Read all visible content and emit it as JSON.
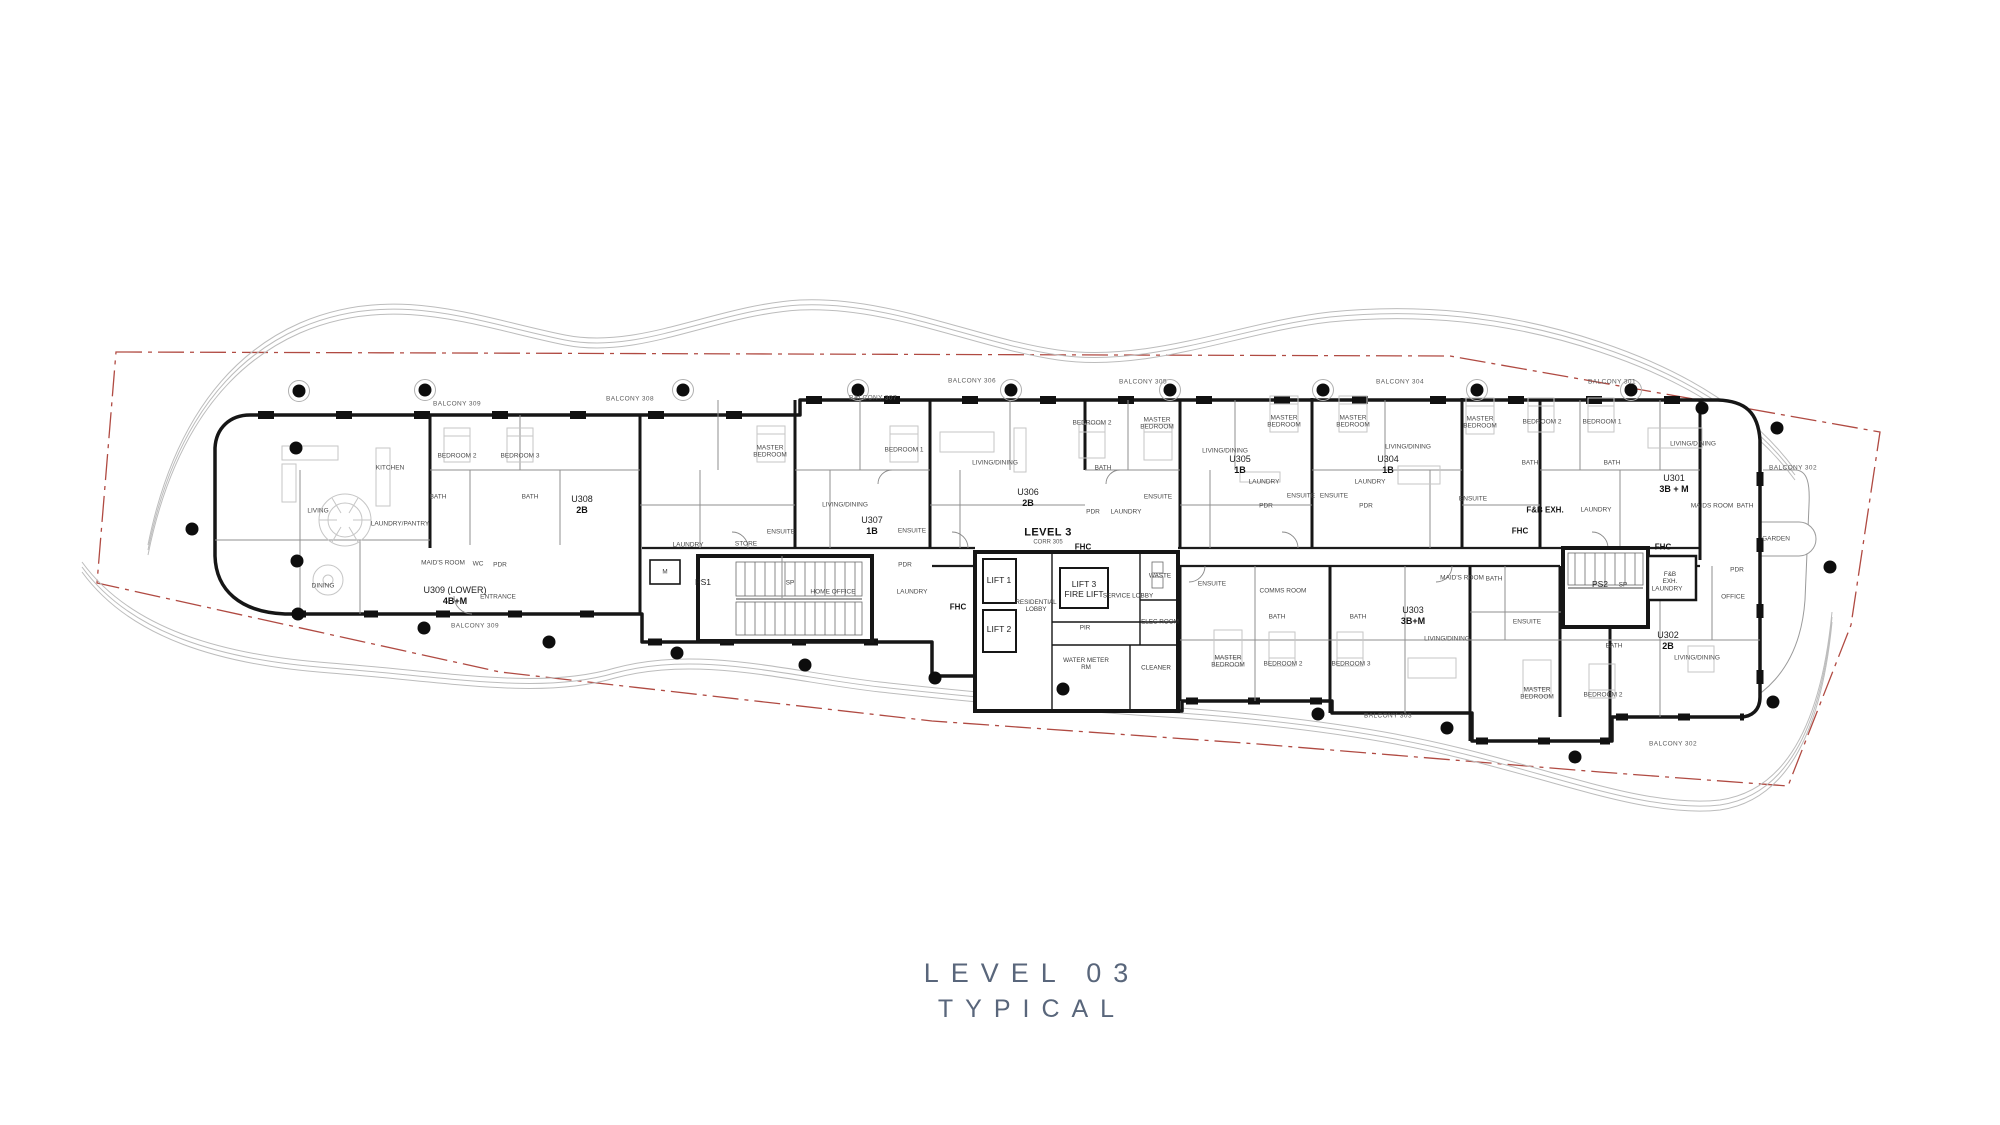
{
  "title": {
    "line1": "LEVEL 03",
    "line2": "TYPICAL"
  },
  "colors": {
    "boundary_red": "#b04a42",
    "wall_black": "#161616",
    "landscape_gray": "#b9b9b9",
    "furniture_gray": "#c6c6c6",
    "title_color": "#59667b"
  },
  "plan": {
    "level_label": "LEVEL 3",
    "corridor_label": "CORR 305",
    "units": [
      {
        "id": "U309 (LOWER)",
        "type": "4B+M"
      },
      {
        "id": "U308",
        "type": "2B"
      },
      {
        "id": "U307",
        "type": "1B"
      },
      {
        "id": "U306",
        "type": "2B"
      },
      {
        "id": "U305",
        "type": "1B"
      },
      {
        "id": "U304",
        "type": "1B"
      },
      {
        "id": "U303",
        "type": "3B+M"
      },
      {
        "id": "U302",
        "type": "2B"
      },
      {
        "id": "U301",
        "type": "3B + M"
      }
    ],
    "labels": [
      {
        "t": "U309 (LOWER)",
        "x": 455,
        "y": 590,
        "k": "uid"
      },
      {
        "t": "4B+M",
        "x": 455,
        "y": 601,
        "k": "utype"
      },
      {
        "t": "U308",
        "x": 582,
        "y": 499,
        "k": "uid"
      },
      {
        "t": "2B",
        "x": 582,
        "y": 510,
        "k": "utype"
      },
      {
        "t": "U307",
        "x": 872,
        "y": 520,
        "k": "uid"
      },
      {
        "t": "1B",
        "x": 872,
        "y": 531,
        "k": "utype"
      },
      {
        "t": "U306",
        "x": 1028,
        "y": 492,
        "k": "uid"
      },
      {
        "t": "2B",
        "x": 1028,
        "y": 503,
        "k": "utype"
      },
      {
        "t": "U305",
        "x": 1240,
        "y": 459,
        "k": "uid"
      },
      {
        "t": "1B",
        "x": 1240,
        "y": 470,
        "k": "utype"
      },
      {
        "t": "U304",
        "x": 1388,
        "y": 459,
        "k": "uid"
      },
      {
        "t": "1B",
        "x": 1388,
        "y": 470,
        "k": "utype"
      },
      {
        "t": "U301",
        "x": 1674,
        "y": 478,
        "k": "uid"
      },
      {
        "t": "3B + M",
        "x": 1674,
        "y": 489,
        "k": "utype"
      },
      {
        "t": "U303",
        "x": 1413,
        "y": 610,
        "k": "uid"
      },
      {
        "t": "3B+M",
        "x": 1413,
        "y": 621,
        "k": "utype"
      },
      {
        "t": "U302",
        "x": 1668,
        "y": 635,
        "k": "uid"
      },
      {
        "t": "2B",
        "x": 1668,
        "y": 646,
        "k": "utype"
      },
      {
        "t": "LEVEL 3",
        "x": 1048,
        "y": 533,
        "k": "corr"
      },
      {
        "t": "CORR 305",
        "x": 1048,
        "y": 543,
        "k": "corrsub"
      },
      {
        "t": "FHC",
        "x": 958,
        "y": 607,
        "k": "fhc"
      },
      {
        "t": "FHC",
        "x": 1083,
        "y": 547,
        "k": "fhc"
      },
      {
        "t": "FHC",
        "x": 1520,
        "y": 531,
        "k": "fhc"
      },
      {
        "t": "FHC",
        "x": 1663,
        "y": 547,
        "k": "fhc"
      },
      {
        "t": "LIFT 1",
        "x": 999,
        "y": 581,
        "k": "lift"
      },
      {
        "t": "LIFT 2",
        "x": 999,
        "y": 630,
        "k": "lift"
      },
      {
        "t": "LIFT 3\nFIRE LIFT",
        "x": 1084,
        "y": 590,
        "k": "lift"
      },
      {
        "t": "RESIDENTIAL\nLOBBY",
        "x": 1036,
        "y": 606,
        "k": "core"
      },
      {
        "t": "SERVICE LOBBY",
        "x": 1128,
        "y": 596,
        "k": "core"
      },
      {
        "t": "WASTE",
        "x": 1160,
        "y": 576,
        "k": "core"
      },
      {
        "t": "ELEC ROOM",
        "x": 1160,
        "y": 622,
        "k": "core"
      },
      {
        "t": "PIR",
        "x": 1085,
        "y": 628,
        "k": "core"
      },
      {
        "t": "WATER METER\nRM",
        "x": 1086,
        "y": 664,
        "k": "core"
      },
      {
        "t": "CLEANER",
        "x": 1156,
        "y": 668,
        "k": "core"
      },
      {
        "t": "M",
        "x": 665,
        "y": 572,
        "k": "core"
      },
      {
        "t": "PS1",
        "x": 703,
        "y": 583,
        "k": "lift"
      },
      {
        "t": "SP",
        "x": 790,
        "y": 583,
        "k": "core"
      },
      {
        "t": "PS2",
        "x": 1600,
        "y": 585,
        "k": "lift"
      },
      {
        "t": "SP",
        "x": 1623,
        "y": 585,
        "k": "core"
      },
      {
        "t": "F&B\nEXH.",
        "x": 1670,
        "y": 578,
        "k": "core"
      },
      {
        "t": "F&B EXH.",
        "x": 1545,
        "y": 510,
        "k": "fhc"
      },
      {
        "t": "LIVING",
        "x": 318,
        "y": 511,
        "k": "room"
      },
      {
        "t": "DINING",
        "x": 323,
        "y": 586,
        "k": "room"
      },
      {
        "t": "KITCHEN",
        "x": 390,
        "y": 468,
        "k": "room"
      },
      {
        "t": "LAUNDRY/PANTRY",
        "x": 400,
        "y": 524,
        "k": "room"
      },
      {
        "t": "MAID'S ROOM",
        "x": 443,
        "y": 563,
        "k": "room"
      },
      {
        "t": "WC",
        "x": 478,
        "y": 564,
        "k": "room"
      },
      {
        "t": "PDR",
        "x": 500,
        "y": 565,
        "k": "room"
      },
      {
        "t": "ENTRANCE",
        "x": 498,
        "y": 597,
        "k": "room"
      },
      {
        "t": "BATH",
        "x": 438,
        "y": 497,
        "k": "room"
      },
      {
        "t": "BATH",
        "x": 530,
        "y": 497,
        "k": "room"
      },
      {
        "t": "BEDROOM 2",
        "x": 457,
        "y": 456,
        "k": "room"
      },
      {
        "t": "BEDROOM 3",
        "x": 520,
        "y": 456,
        "k": "room"
      },
      {
        "t": "MASTER\nBEDROOM",
        "x": 770,
        "y": 452,
        "k": "room"
      },
      {
        "t": "BEDROOM 1",
        "x": 904,
        "y": 450,
        "k": "room"
      },
      {
        "t": "LIVING/DINING",
        "x": 845,
        "y": 505,
        "k": "room"
      },
      {
        "t": "ENSUITE",
        "x": 781,
        "y": 532,
        "k": "room"
      },
      {
        "t": "ENSUITE",
        "x": 912,
        "y": 531,
        "k": "room"
      },
      {
        "t": "PDR",
        "x": 905,
        "y": 565,
        "k": "room"
      },
      {
        "t": "LAUNDRY",
        "x": 688,
        "y": 545,
        "k": "room"
      },
      {
        "t": "STORE",
        "x": 746,
        "y": 544,
        "k": "room"
      },
      {
        "t": "HOME OFFICE",
        "x": 833,
        "y": 592,
        "k": "room"
      },
      {
        "t": "LAUNDRY",
        "x": 912,
        "y": 592,
        "k": "room"
      },
      {
        "t": "LIVING/DINING",
        "x": 995,
        "y": 463,
        "k": "room"
      },
      {
        "t": "BEDROOM 2",
        "x": 1092,
        "y": 423,
        "k": "room"
      },
      {
        "t": "MASTER\nBEDROOM",
        "x": 1157,
        "y": 424,
        "k": "room"
      },
      {
        "t": "BATH",
        "x": 1103,
        "y": 468,
        "k": "room"
      },
      {
        "t": "ENSUITE",
        "x": 1158,
        "y": 497,
        "k": "room"
      },
      {
        "t": "PDR",
        "x": 1093,
        "y": 512,
        "k": "room"
      },
      {
        "t": "LAUNDRY",
        "x": 1126,
        "y": 512,
        "k": "room"
      },
      {
        "t": "LIVING/DINING",
        "x": 1225,
        "y": 451,
        "k": "room"
      },
      {
        "t": "MASTER\nBEDROOM",
        "x": 1284,
        "y": 422,
        "k": "room"
      },
      {
        "t": "LAUNDRY",
        "x": 1264,
        "y": 482,
        "k": "room"
      },
      {
        "t": "ENSUITE",
        "x": 1301,
        "y": 496,
        "k": "room"
      },
      {
        "t": "PDR",
        "x": 1266,
        "y": 506,
        "k": "room"
      },
      {
        "t": "MASTER\nBEDROOM",
        "x": 1353,
        "y": 422,
        "k": "room"
      },
      {
        "t": "ENSUITE",
        "x": 1334,
        "y": 496,
        "k": "room"
      },
      {
        "t": "LAUNDRY",
        "x": 1370,
        "y": 482,
        "k": "room"
      },
      {
        "t": "PDR",
        "x": 1366,
        "y": 506,
        "k": "room"
      },
      {
        "t": "LIVING/DINING",
        "x": 1408,
        "y": 447,
        "k": "room"
      },
      {
        "t": "MASTER\nBEDROOM",
        "x": 1480,
        "y": 423,
        "k": "room"
      },
      {
        "t": "BEDROOM 2",
        "x": 1542,
        "y": 422,
        "k": "room"
      },
      {
        "t": "BEDROOM 1",
        "x": 1602,
        "y": 422,
        "k": "room"
      },
      {
        "t": "BATH",
        "x": 1530,
        "y": 463,
        "k": "room"
      },
      {
        "t": "BATH",
        "x": 1612,
        "y": 463,
        "k": "room"
      },
      {
        "t": "ENSUITE",
        "x": 1473,
        "y": 499,
        "k": "room"
      },
      {
        "t": "LAUNDRY",
        "x": 1596,
        "y": 510,
        "k": "room"
      },
      {
        "t": "LIVING/DINING",
        "x": 1693,
        "y": 444,
        "k": "room"
      },
      {
        "t": "MAIDS ROOM",
        "x": 1712,
        "y": 506,
        "k": "room"
      },
      {
        "t": "BATH",
        "x": 1745,
        "y": 506,
        "k": "room"
      },
      {
        "t": "ENSUITE",
        "x": 1212,
        "y": 584,
        "k": "room"
      },
      {
        "t": "MASTER\nBEDROOM",
        "x": 1228,
        "y": 662,
        "k": "room"
      },
      {
        "t": "COMMS ROOM",
        "x": 1283,
        "y": 591,
        "k": "room"
      },
      {
        "t": "BATH",
        "x": 1277,
        "y": 617,
        "k": "room"
      },
      {
        "t": "BATH",
        "x": 1358,
        "y": 617,
        "k": "room"
      },
      {
        "t": "BEDROOM 2",
        "x": 1283,
        "y": 664,
        "k": "room"
      },
      {
        "t": "BEDROOM 3",
        "x": 1351,
        "y": 664,
        "k": "room"
      },
      {
        "t": "LIVING/DINING",
        "x": 1447,
        "y": 639,
        "k": "room"
      },
      {
        "t": "MAID'S ROOM",
        "x": 1462,
        "y": 578,
        "k": "room"
      },
      {
        "t": "BATH",
        "x": 1494,
        "y": 579,
        "k": "room"
      },
      {
        "t": "ENSUITE",
        "x": 1527,
        "y": 622,
        "k": "room"
      },
      {
        "t": "MASTER\nBEDROOM",
        "x": 1537,
        "y": 694,
        "k": "room"
      },
      {
        "t": "BATH",
        "x": 1614,
        "y": 646,
        "k": "room"
      },
      {
        "t": "BEDROOM 2",
        "x": 1603,
        "y": 695,
        "k": "room"
      },
      {
        "t": "LIVING/DINING",
        "x": 1697,
        "y": 658,
        "k": "room"
      },
      {
        "t": "LAUNDRY",
        "x": 1667,
        "y": 589,
        "k": "room"
      },
      {
        "t": "PDR",
        "x": 1737,
        "y": 570,
        "k": "room"
      },
      {
        "t": "OFFICE",
        "x": 1733,
        "y": 597,
        "k": "room"
      },
      {
        "t": "GARDEN",
        "x": 1776,
        "y": 539,
        "k": "room"
      },
      {
        "t": "BALCONY 309",
        "x": 457,
        "y": 404,
        "k": "balc"
      },
      {
        "t": "BALCONY 308",
        "x": 630,
        "y": 399,
        "k": "balc"
      },
      {
        "t": "BALCONY 307",
        "x": 873,
        "y": 398,
        "k": "balc"
      },
      {
        "t": "BALCONY 306",
        "x": 972,
        "y": 381,
        "k": "balc"
      },
      {
        "t": "BALCONY 305",
        "x": 1143,
        "y": 382,
        "k": "balc"
      },
      {
        "t": "BALCONY 304",
        "x": 1400,
        "y": 382,
        "k": "balc"
      },
      {
        "t": "BALCONY 301",
        "x": 1612,
        "y": 382,
        "k": "balc"
      },
      {
        "t": "BALCONY 302",
        "x": 1793,
        "y": 468,
        "k": "balc"
      },
      {
        "t": "BALCONY 309",
        "x": 475,
        "y": 626,
        "k": "balc"
      },
      {
        "t": "BALCONY 303",
        "x": 1388,
        "y": 716,
        "k": "balc"
      },
      {
        "t": "BALCONY 302",
        "x": 1673,
        "y": 744,
        "k": "balc"
      }
    ]
  }
}
